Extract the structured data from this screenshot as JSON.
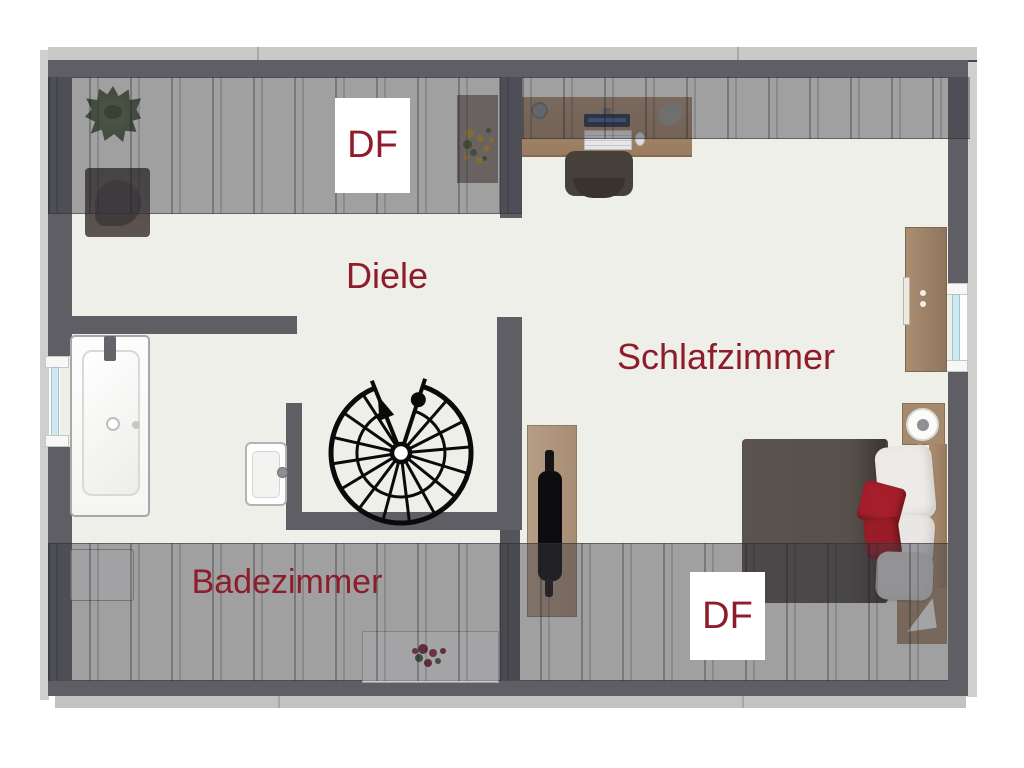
{
  "floorplan": {
    "rooms": [
      {
        "id": "diele",
        "label": "Diele"
      },
      {
        "id": "schlafzimmer",
        "label": "Schlafzimmer"
      },
      {
        "id": "badezimmer",
        "label": "Badezimmer"
      }
    ],
    "roof_windows": [
      {
        "id": "df-top",
        "label": "DF"
      },
      {
        "id": "df-bottom",
        "label": "DF"
      }
    ],
    "colors": {
      "room_label": "#8e1c2b",
      "wall": "#5e5e64",
      "floor": "#efefea",
      "roof_slope_overlay": "rgba(60,60,68,0.44)",
      "window_glass": "#cfe9f0",
      "wood": "#a8876a",
      "bed_blanket": "#57504b",
      "cushion_red": "#a41f2b"
    },
    "furniture": [
      "spiral-staircase",
      "bathtub",
      "washbasin",
      "desk",
      "office-chair",
      "bed",
      "wardrobe",
      "nightstand",
      "tv-board",
      "potted-plant",
      "flower-rug",
      "armchair",
      "storage-shelf"
    ]
  }
}
